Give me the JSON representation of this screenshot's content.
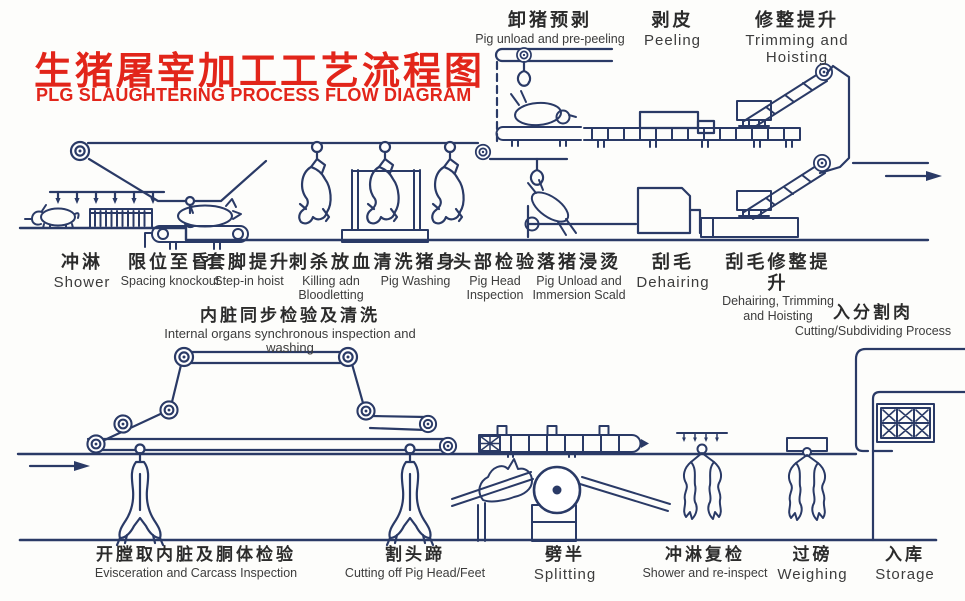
{
  "title": {
    "zh": "生猪屠宰加工工艺流程图",
    "en": "PLG SLAUGHTERING PROCESS FLOW DIAGRAM"
  },
  "colors": {
    "title_red": "#e2251a",
    "line_ink": "#2a3a66",
    "label_text": "#2b2b2b"
  },
  "stations": {
    "top": [
      {
        "zh": "卸猪预剥",
        "en": "Pig unload and pre-peeling"
      },
      {
        "zh": "剥皮",
        "en": "Peeling"
      },
      {
        "zh": "修整提升",
        "en": "Trimming and Hoisting"
      }
    ],
    "middle": [
      {
        "zh": "冲淋",
        "en": "Shower"
      },
      {
        "zh": "限位至昏",
        "en": "Spacing knockout"
      },
      {
        "zh": "套脚提升",
        "en": "Step-in hoist"
      },
      {
        "zh": "刺杀放血",
        "en": "Killing adn Bloodletting"
      },
      {
        "zh": "清洗猪身",
        "en": "Pig Washing"
      },
      {
        "zh": "头部检验",
        "en": "Pig Head Inspection"
      },
      {
        "zh": "落猪浸烫",
        "en": "Pig Unload and Immersion Scald"
      },
      {
        "zh": "刮毛",
        "en": "Dehairing"
      },
      {
        "zh": "刮毛修整提升",
        "en": "Dehairing, Trimming and Hoisting"
      }
    ],
    "inspection": {
      "zh": "内脏同步检验及清洗",
      "en": "Internal organs synchronous inspection and washing"
    },
    "cutting": {
      "zh": "入分割肉",
      "en": "Cutting/Subdividing Process"
    },
    "bottom": [
      {
        "zh": "开膛取内脏及胴体检验",
        "en": "Evisceration and Carcass Inspection"
      },
      {
        "zh": "割头蹄",
        "en": "Cutting off Pig Head/Feet"
      },
      {
        "zh": "劈半",
        "en": "Splitting"
      },
      {
        "zh": "冲淋复检",
        "en": "Shower and re-inspect"
      },
      {
        "zh": "过磅",
        "en": "Weighing"
      },
      {
        "zh": "入库",
        "en": "Storage"
      }
    ]
  }
}
